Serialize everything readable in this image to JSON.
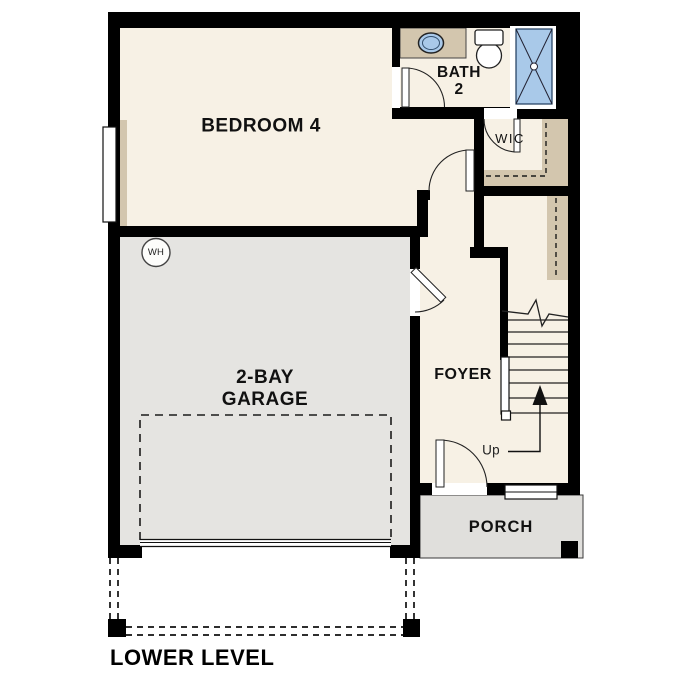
{
  "plan": {
    "title": "LOWER LEVEL",
    "rooms": {
      "bedroom4": "BEDROOM 4",
      "bath_line1": "BATH",
      "bath_line2": "2",
      "wic": "WIC",
      "foyer": "FOYER",
      "garage_line1": "2-BAY",
      "garage_line2": "GARAGE",
      "porch": "PORCH"
    },
    "annotations": {
      "up": "Up",
      "water_heater": "WH"
    },
    "colors": {
      "floor": "#f7f1e5",
      "garage_floor": "#e5e4e1",
      "porch_floor": "#e0dfdc",
      "casework": "#d3c6ae",
      "fixture_blue": "#a9c9e9",
      "wall": "#000000"
    }
  }
}
